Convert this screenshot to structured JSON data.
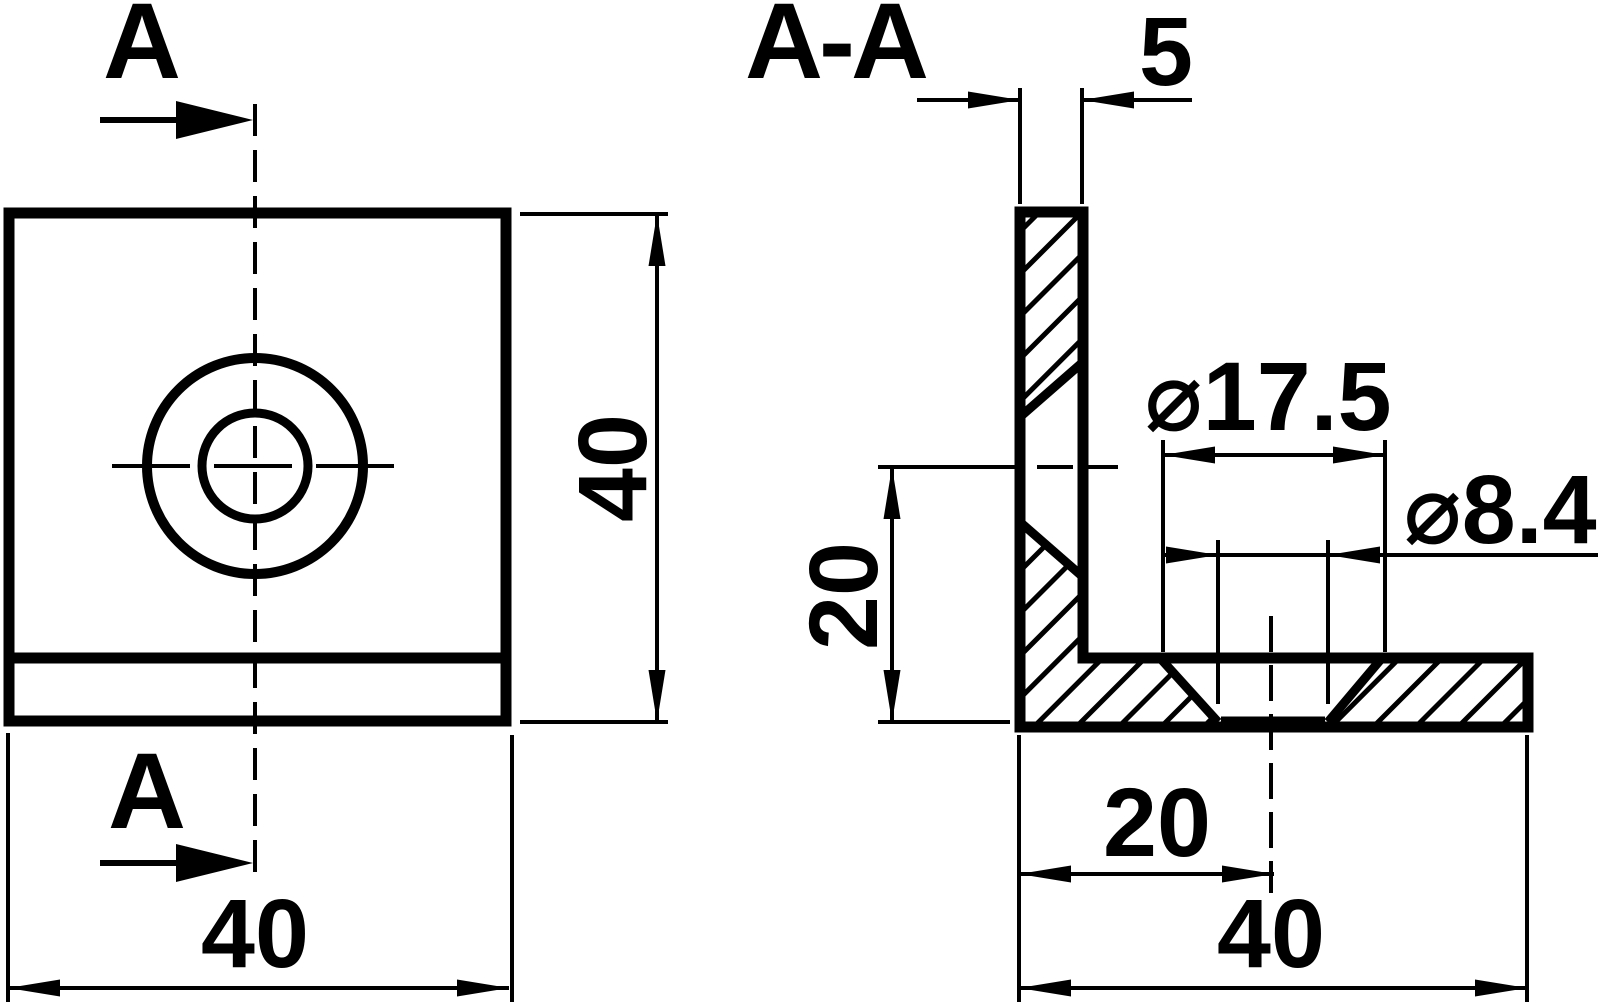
{
  "drawing": {
    "front_view": {
      "section_label_top": "A",
      "section_label_bottom": "A",
      "width_dim": "40",
      "height_dim": "40"
    },
    "section_view": {
      "title": "A-A",
      "thickness_dim": "5",
      "countersink_dia_dim": "⌀17.5",
      "hole_dia_dim": "⌀8.4",
      "hole_height_dim": "20",
      "hole_offset_dim": "20",
      "width_dim": "40"
    },
    "colors": {
      "ink": "#000000",
      "paper": "#ffffff"
    }
  }
}
